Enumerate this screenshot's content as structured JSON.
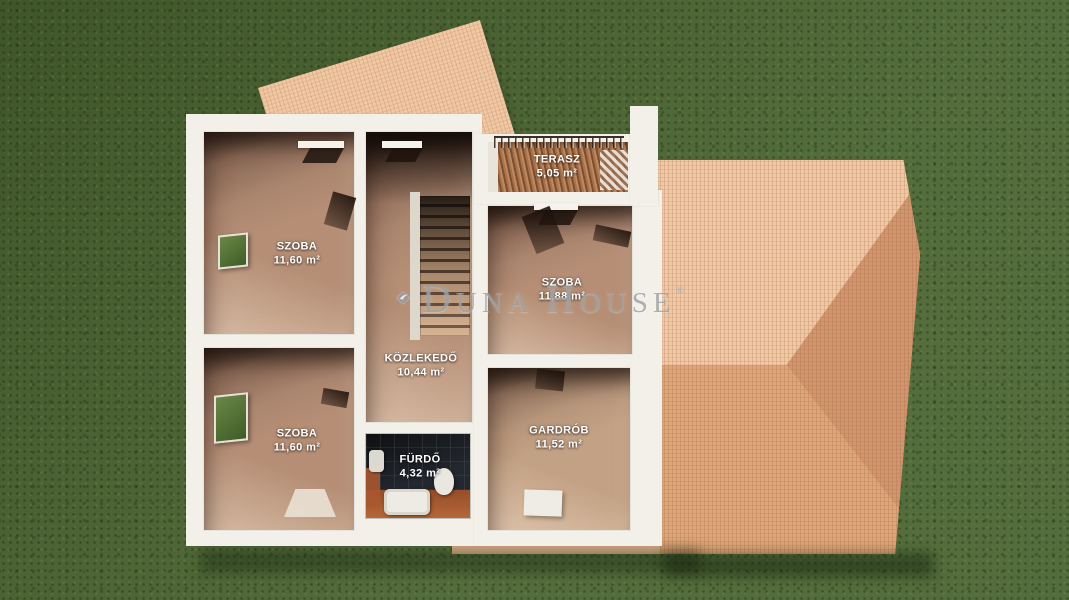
{
  "watermark": {
    "brand": "Duna House",
    "registered": "®",
    "parts": {
      "d": "D",
      "una": "UNA",
      "h": "H",
      "ouse": "OUSE"
    }
  },
  "rooms": {
    "terasz": {
      "name": "TERASZ",
      "area": "5,05 m²"
    },
    "szoba_tl": {
      "name": "SZOBA",
      "area": "11,60 m²"
    },
    "szoba_r": {
      "name": "SZOBA",
      "area": "11,88 m²"
    },
    "kozlekedo": {
      "name": "KÖZLEKEDŐ",
      "area": "10,44 m²"
    },
    "szoba_bl": {
      "name": "SZOBA",
      "area": "11,60 m²"
    },
    "gardrob": {
      "name": "GARDRÓB",
      "area": "11,52 m²"
    },
    "furdo": {
      "name": "FÜRDŐ",
      "area": "4,32 m²"
    }
  },
  "colors": {
    "grass": "#4a6430",
    "wall": "#f3f0e9",
    "floor": "#b58e75",
    "roof_light": "#f0c8a4",
    "roof_dark": "#d2966e",
    "watermark": "#9fa3a7"
  }
}
